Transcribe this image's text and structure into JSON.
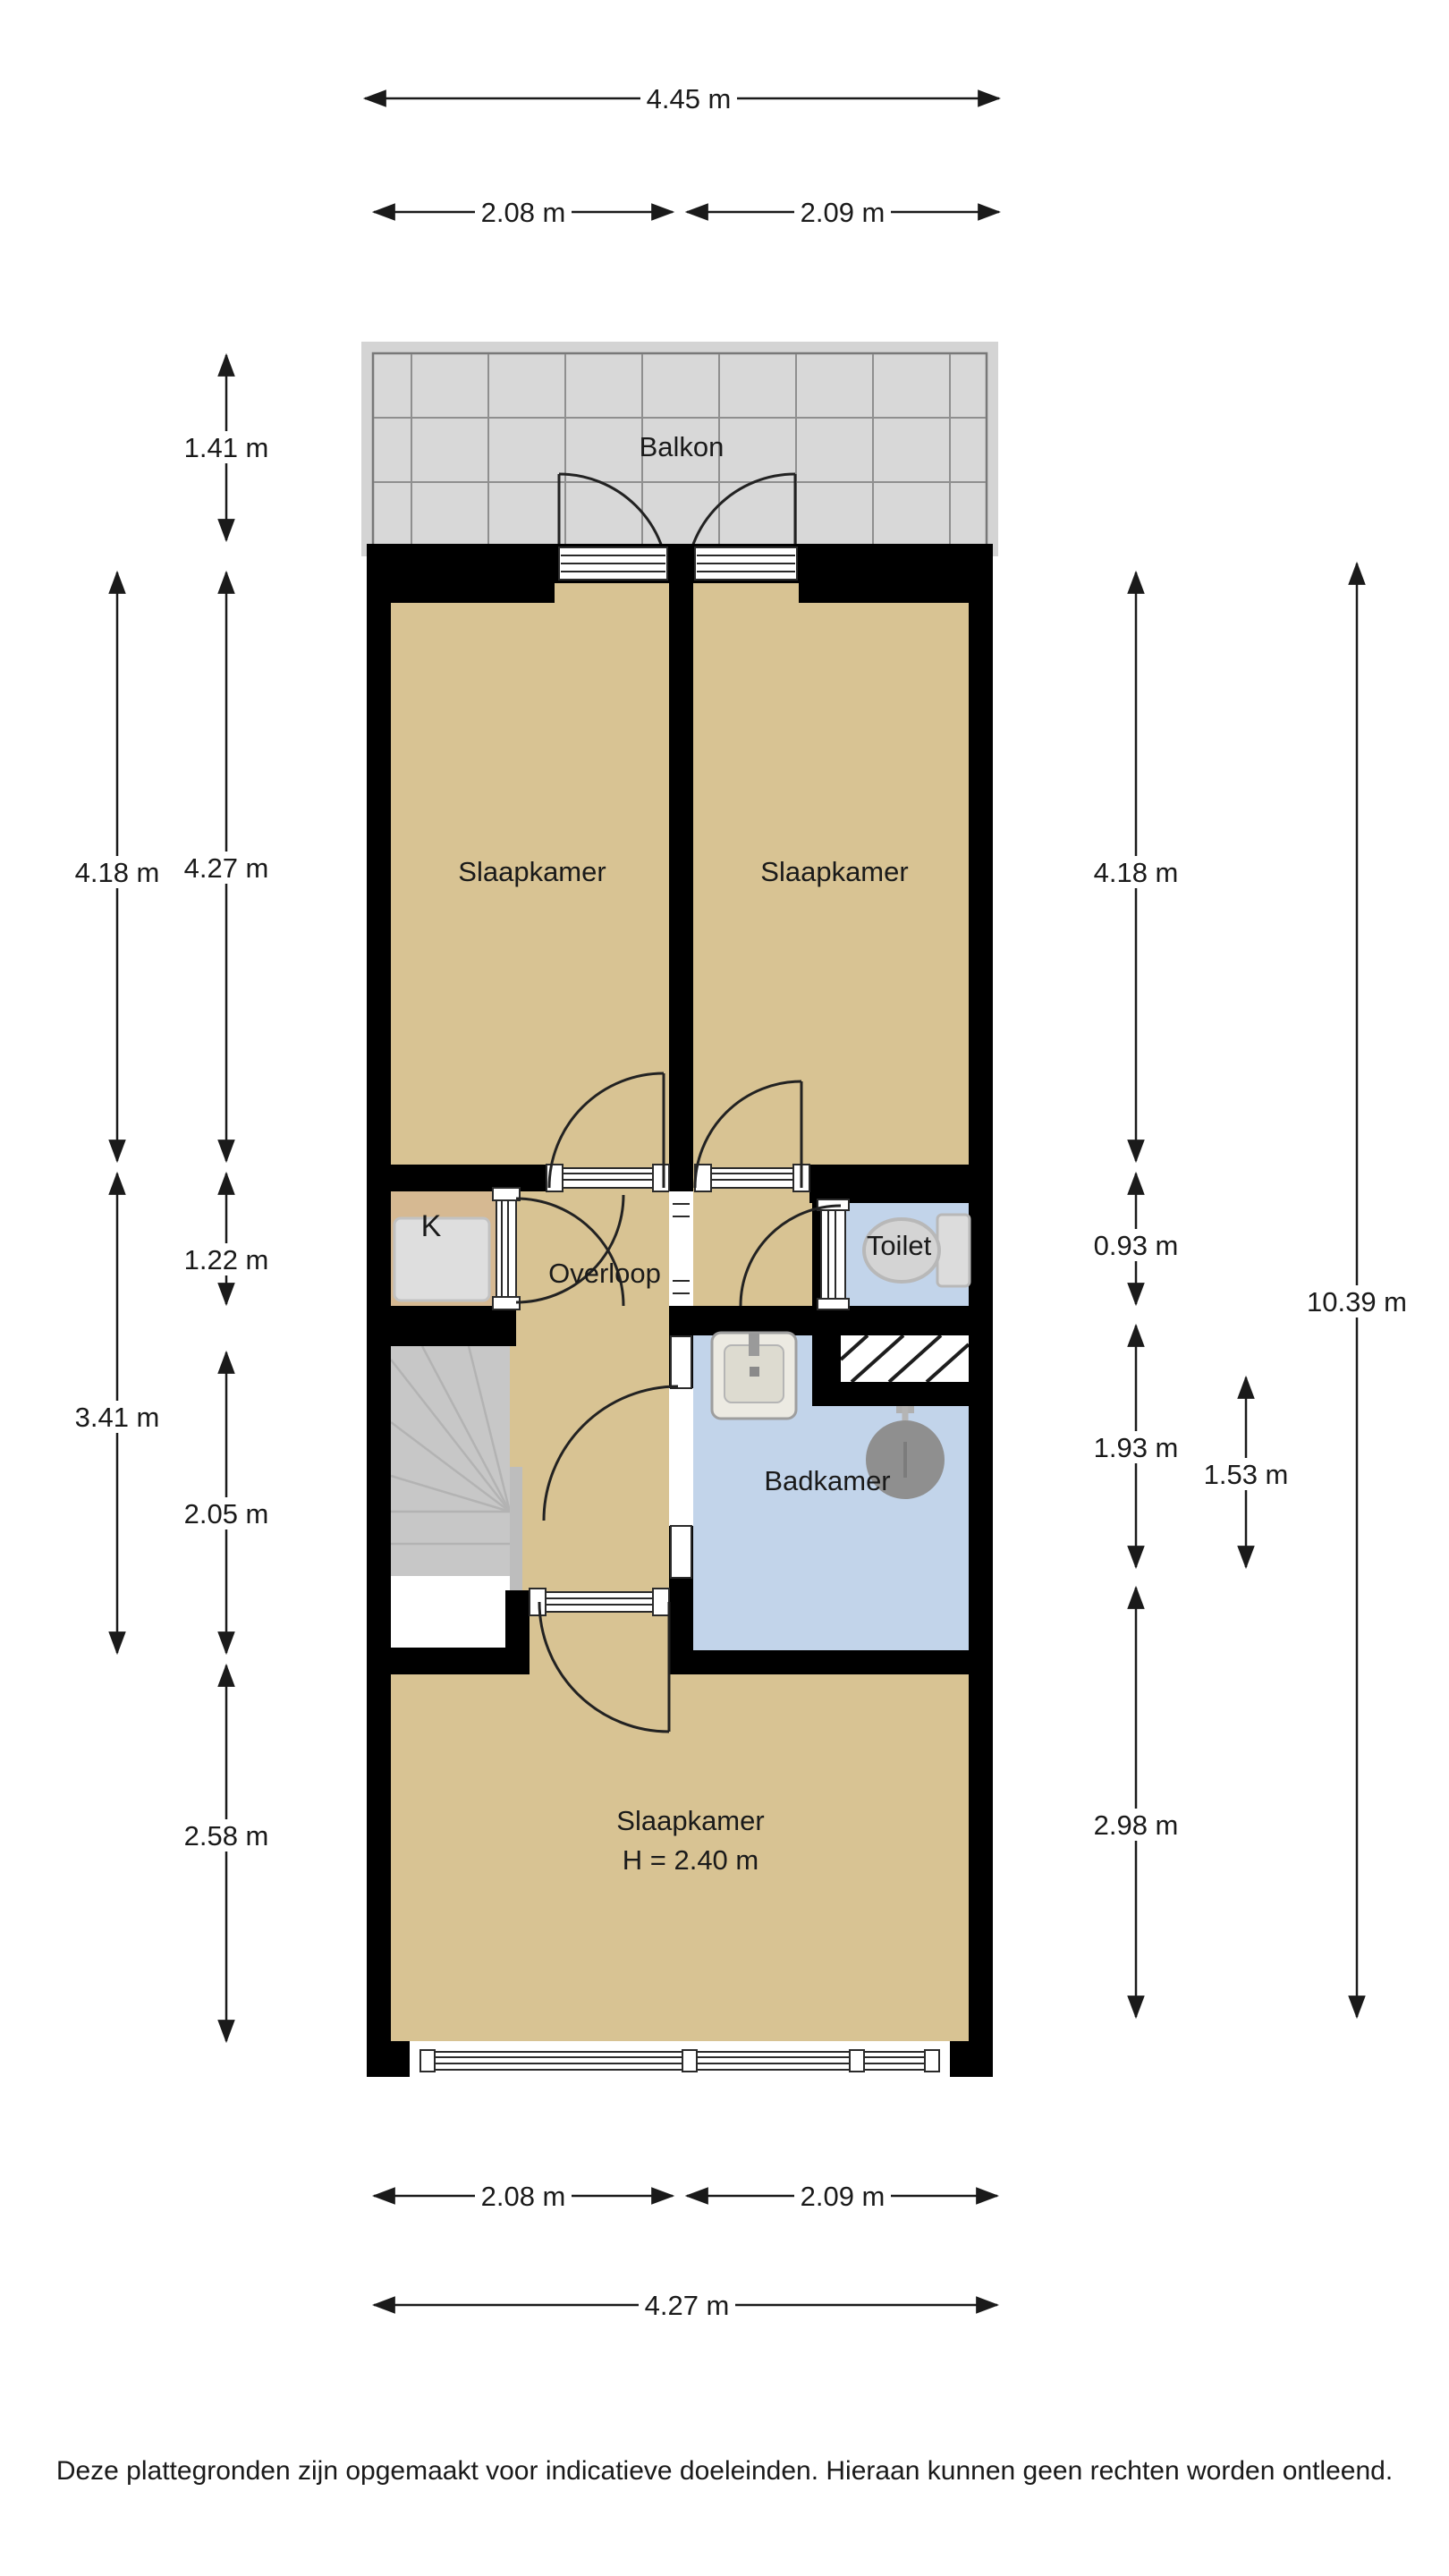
{
  "title": "Plattegrond verdieping",
  "labels": {
    "balkon": "Balkon",
    "bedroom_left": "Slaapkamer",
    "bedroom_right": "Slaapkamer",
    "closet": "K",
    "overloop": "Overloop",
    "toilet": "Toilet",
    "badkamer": "Badkamer",
    "bedroom_bottom": "Slaapkamer",
    "bedroom_bottom_ceiling": "H = 2.40 m"
  },
  "dims": {
    "top_total": "4.45 m",
    "top_left": "2.08 m",
    "top_right": "2.09 m",
    "balcony_depth": "1.41 m",
    "left_outer_top": "4.18 m",
    "left_inner_top": "4.27 m",
    "left_inner_mid": "1.22 m",
    "left_outer_mid": "3.41 m",
    "left_inner_low": "2.05 m",
    "left_inner_bottom": "2.58 m",
    "right_top": "4.18 m",
    "right_toilet": "0.93 m",
    "right_bath": "1.93 m",
    "right_bath_inner": "1.53 m",
    "right_bottom": "2.98 m",
    "right_total": "10.39 m",
    "bottom_left": "2.08 m",
    "bottom_right": "2.09 m",
    "bottom_total": "4.27 m"
  },
  "colors": {
    "floor": "#d8c393",
    "closet_floor": "#d6b992",
    "wet_room": "#c2d4ea",
    "balcony": "#d8d8d8",
    "stairs": "#c7c7c7",
    "wall": "#000000"
  },
  "icons": {
    "toilet": "toilet-icon",
    "sink": "sink-icon",
    "shower": "shower-head-icon",
    "stairs": "stairs-icon",
    "appliance": "closet-appliance-icon"
  },
  "disclaimer": "Deze plattegronden zijn opgemaakt voor indicatieve doeleinden. Hieraan kunnen geen rechten worden ontleend."
}
